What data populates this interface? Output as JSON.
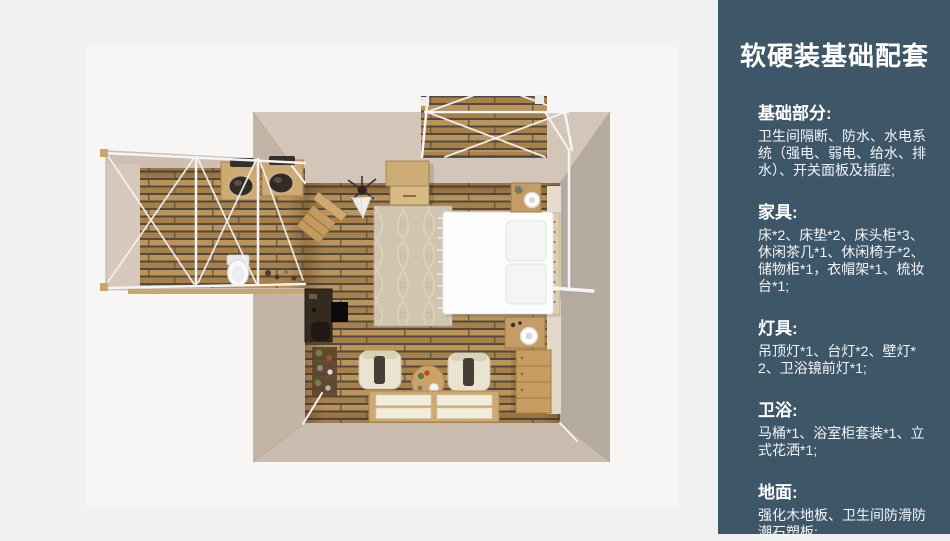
{
  "page": {
    "background": "#f1f1f1"
  },
  "sidebar": {
    "background": "#3d5668",
    "title": "软硬装基础配套",
    "sections": [
      {
        "heading": "基础部分:",
        "body": "卫生间隔断、防水、水电系统（强电、弱电、给水、排水）、开关面板及插座;"
      },
      {
        "heading": "家具:",
        "body": "床*2、床垫*2、床头柜*3、休闲茶几*1、休闲椅子*2、储物柜*1，衣帽架*1、梳妆台*1;"
      },
      {
        "heading": "灯具:",
        "body": "吊顶灯*1、台灯*2、壁灯*2、卫浴镜前灯*1;"
      },
      {
        "heading": "卫浴:",
        "body": "马桶*1、浴室柜套装*1、立式花洒*1;"
      },
      {
        "heading": "地面:",
        "body": "强化木地板、卫生间防滑防潮石塑板;"
      }
    ]
  },
  "floorplan": {
    "colors": {
      "wood_floor": "#b98e52",
      "plank_gap": "#4f4a45",
      "wall_outer": "#c3b4a6",
      "wall_inner": "#d3c6b8",
      "frame_white": "#f4f4f4",
      "furniture_wood": "#c79e62",
      "bed_white": "#fcfcfd"
    },
    "items": [
      "balcony-deck",
      "canopy-frame",
      "bathroom",
      "sink",
      "sink",
      "toilet",
      "clothes-rack",
      "storage-cabinet",
      "plant",
      "teepee-decor",
      "rug",
      "bed",
      "pillow",
      "nightstand",
      "nightstand",
      "dresser",
      "desk",
      "desk-chair",
      "corner-shelf",
      "armchair",
      "armchair",
      "tea-table",
      "tatami-platform"
    ]
  }
}
